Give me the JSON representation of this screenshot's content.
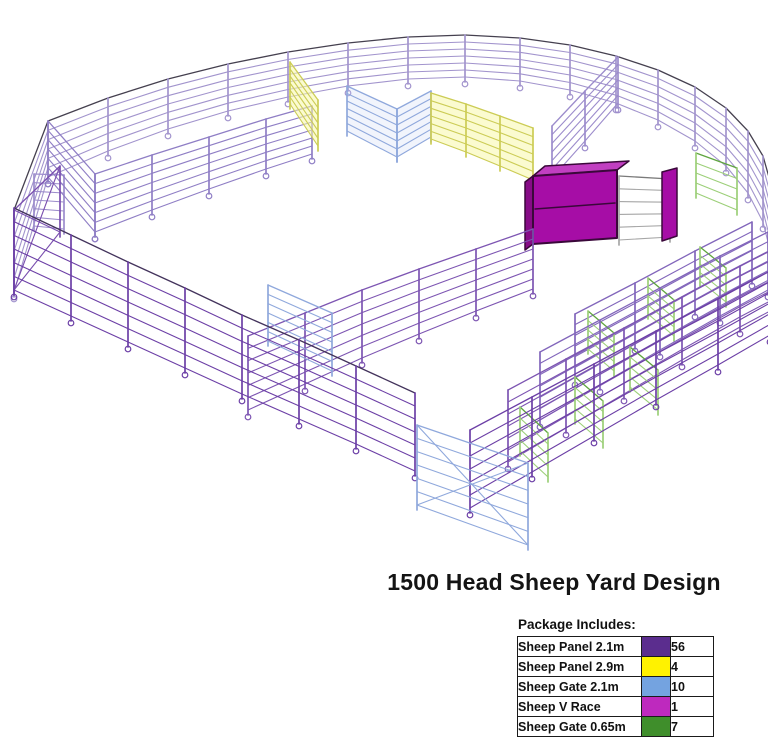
{
  "title": "1500 Head Sheep Yard Design",
  "legend": {
    "header": "Package Includes:",
    "rows": [
      {
        "label": "Sheep Panel 2.1m",
        "color": "#5B2D8E",
        "qty": "56"
      },
      {
        "label": "Sheep Panel 2.9m",
        "color": "#FFF200",
        "qty": "4"
      },
      {
        "label": "Sheep Gate 2.1m",
        "color": "#74A3E0",
        "qty": "10"
      },
      {
        "label": "Sheep V Race",
        "color": "#BE29BE",
        "qty": "1"
      },
      {
        "label": "Sheep Gate 0.65m",
        "color": "#3F8E2B",
        "qty": "7"
      }
    ]
  },
  "diagram": {
    "width": 768,
    "height": 560,
    "colors": {
      "panel_far": "#A294CD",
      "panel_near": "#6C3FA6",
      "panel_mid": "#8266BB",
      "panel_soft": "#8F7EC5",
      "gate_blue": "#8FA8DC",
      "gate_green": "#9CCF78",
      "green_dark": "#5FA53F",
      "panel_yellow": "#CCCC55",
      "vrace_fill": "#A60DA6",
      "vrace_top": "#C13FC1",
      "vrace_dark": "#3A083A",
      "grey": "#A6A6A6",
      "top_rail": "#45404F"
    },
    "elements": [
      {
        "kind": "fence",
        "name": "perimeter-far",
        "c": "#A294CD",
        "top": "#45404F",
        "feet": true,
        "pts": [
          [
            14,
            292,
            82
          ],
          [
            48,
            177,
            56
          ],
          [
            108,
            151,
            53
          ],
          [
            168,
            129,
            50
          ],
          [
            228,
            111,
            47
          ],
          [
            288,
            97,
            45
          ],
          [
            348,
            86,
            43
          ],
          [
            408,
            79,
            42
          ],
          [
            465,
            77,
            42
          ],
          [
            520,
            81,
            43
          ],
          [
            570,
            90,
            45
          ],
          [
            616,
            103,
            47
          ],
          [
            658,
            120,
            50
          ],
          [
            695,
            141,
            54
          ],
          [
            726,
            166,
            58
          ],
          [
            748,
            193,
            62
          ],
          [
            763,
            222,
            66
          ],
          [
            772,
            258,
            70
          ]
        ]
      },
      {
        "kind": "fence",
        "name": "gate-top-left",
        "c": "#9C8CCC",
        "feet": false,
        "pts": [
          [
            34,
            226,
            52
          ],
          [
            64,
            229,
            54
          ]
        ]
      },
      {
        "kind": "fence",
        "name": "spur-top-left",
        "c": "#8F7EC5",
        "feet": true,
        "pts": [
          [
            48,
            177,
            56
          ],
          [
            95,
            232,
            58
          ]
        ]
      },
      {
        "kind": "fence",
        "name": "spur-forcing",
        "c": "#9C8CCC",
        "feet": true,
        "pts": [
          [
            618,
            103,
            46
          ],
          [
            585,
            141,
            50
          ],
          [
            552,
            178,
            52
          ]
        ]
      },
      {
        "kind": "fence",
        "name": "divider-1",
        "c": "#8F7EC5",
        "feet": true,
        "pts": [
          [
            95,
            232,
            58
          ],
          [
            152,
            210,
            55
          ],
          [
            209,
            189,
            52
          ],
          [
            266,
            169,
            50
          ],
          [
            312,
            154,
            48
          ]
        ]
      },
      {
        "kind": "fence",
        "name": "panel-yellow-left",
        "c": "#CCCC55",
        "fill": "rgba(247,247,170,0.55)",
        "feet": false,
        "pts": [
          [
            290,
            104,
            42
          ],
          [
            318,
            146,
            46
          ]
        ]
      },
      {
        "kind": "fence",
        "name": "gate-mid-1",
        "c": "#8FA8DC",
        "fill": "rgba(190,205,240,0.22)",
        "feet": false,
        "pts": [
          [
            347,
            131,
            45
          ],
          [
            397,
            157,
            48
          ]
        ]
      },
      {
        "kind": "fence",
        "name": "gate-mid-2",
        "c": "#8FA8DC",
        "fill": "rgba(190,205,240,0.22)",
        "feet": false,
        "pts": [
          [
            397,
            157,
            48
          ],
          [
            431,
            137,
            46
          ]
        ]
      },
      {
        "kind": "fence",
        "name": "panels-yellow-run",
        "c": "#CCCC55",
        "fill": "rgba(247,247,170,0.55)",
        "feet": false,
        "pts": [
          [
            431,
            139,
            46
          ],
          [
            466,
            152,
            48
          ],
          [
            500,
            166,
            50
          ],
          [
            533,
            180,
            52
          ]
        ]
      },
      {
        "kind": "polygon",
        "name": "vrace-top-face",
        "fill": "#C13FC1",
        "stroke": "#3A083A",
        "w": 1.5,
        "pts": [
          [
            533,
            176
          ],
          [
            617,
            170
          ],
          [
            629,
            161
          ],
          [
            545,
            166
          ]
        ]
      },
      {
        "kind": "polygon",
        "name": "vrace-left-face",
        "fill": "#870B87",
        "stroke": "#3A083A",
        "w": 1.5,
        "pts": [
          [
            525,
            182
          ],
          [
            533,
            176
          ],
          [
            533,
            244
          ],
          [
            525,
            250
          ]
        ]
      },
      {
        "kind": "polygon",
        "name": "vrace-front-face",
        "fill": "#A60DA6",
        "stroke": "#3A083A",
        "w": 2,
        "pts": [
          [
            533,
            176
          ],
          [
            617,
            170
          ],
          [
            617,
            238
          ],
          [
            533,
            244
          ]
        ]
      },
      {
        "kind": "line",
        "name": "vrace-seam",
        "stroke": "#3A083A",
        "w": 1.5,
        "pts": [
          [
            535,
            209
          ],
          [
            615,
            203
          ]
        ]
      },
      {
        "kind": "fence",
        "name": "race-chassis-grey",
        "c": "#A6A6A6",
        "top": "#7A7A7A",
        "rails": 6,
        "feet": false,
        "pts": [
          [
            619,
            240,
            64
          ],
          [
            670,
            237,
            58
          ]
        ]
      },
      {
        "kind": "polygon",
        "name": "vrace-draft-panel",
        "fill": "#A60DA6",
        "stroke": "#3A083A",
        "w": 1.5,
        "pts": [
          [
            662,
            172
          ],
          [
            677,
            168
          ],
          [
            677,
            236
          ],
          [
            662,
            241
          ]
        ]
      },
      {
        "kind": "fence",
        "name": "gate-green-7",
        "c": "#9CCF78",
        "top": "#5FA53F",
        "rails": 5,
        "feet": false,
        "pts": [
          [
            696,
            193,
            40
          ],
          [
            737,
            210,
            42
          ]
        ]
      },
      {
        "kind": "fence",
        "name": "pen-fence-5",
        "c": "#8266BB",
        "feet": true,
        "pts": [
          [
            575,
            378,
            64
          ],
          [
            635,
            344,
            61
          ],
          [
            695,
            310,
            59
          ],
          [
            752,
            279,
            57
          ]
        ]
      },
      {
        "kind": "fence",
        "name": "gate-green-4",
        "c": "#9CCF78",
        "top": "#5FA53F",
        "rails": 5,
        "feet": false,
        "pts": [
          [
            588,
            349,
            38
          ],
          [
            614,
            371,
            38
          ]
        ]
      },
      {
        "kind": "fence",
        "name": "gate-green-5",
        "c": "#9CCF78",
        "top": "#5FA53F",
        "rails": 5,
        "feet": false,
        "pts": [
          [
            648,
            314,
            36
          ],
          [
            674,
            336,
            36
          ]
        ]
      },
      {
        "kind": "fence",
        "name": "gate-green-6",
        "c": "#9CCF78",
        "top": "#5FA53F",
        "rails": 5,
        "feet": false,
        "pts": [
          [
            700,
            281,
            34
          ],
          [
            726,
            302,
            34
          ]
        ]
      },
      {
        "kind": "fence",
        "name": "pen-fence-4",
        "c": "#8266BB",
        "feet": true,
        "pts": [
          [
            540,
            420,
            68
          ],
          [
            600,
            385,
            65
          ],
          [
            660,
            350,
            62
          ],
          [
            720,
            316,
            60
          ],
          [
            768,
            290,
            58
          ]
        ]
      },
      {
        "kind": "fence",
        "name": "divider-2",
        "c": "#7D55B2",
        "feet": true,
        "pts": [
          [
            248,
            410,
            74
          ],
          [
            305,
            384,
            71
          ],
          [
            362,
            358,
            68
          ],
          [
            419,
            334,
            65
          ],
          [
            476,
            311,
            62
          ],
          [
            533,
            289,
            60
          ]
        ]
      },
      {
        "kind": "fence",
        "name": "gate-divider-2",
        "c": "#8FA8DC",
        "feet": false,
        "pts": [
          [
            268,
            341,
            56
          ],
          [
            332,
            371,
            58
          ]
        ]
      },
      {
        "kind": "fence",
        "name": "race-fence-3",
        "c": "#7D55B2",
        "feet": true,
        "pts": [
          [
            508,
            462,
            72
          ],
          [
            566,
            428,
            69
          ],
          [
            624,
            394,
            66
          ],
          [
            682,
            360,
            63
          ],
          [
            740,
            327,
            61
          ],
          [
            772,
            310,
            60
          ]
        ]
      },
      {
        "kind": "fence",
        "name": "gate-green-1",
        "c": "#9CCF78",
        "top": "#5FA53F",
        "rails": 5,
        "feet": false,
        "pts": [
          [
            520,
            451,
            44
          ],
          [
            548,
            477,
            44
          ]
        ]
      },
      {
        "kind": "fence",
        "name": "gate-green-2",
        "c": "#9CCF78",
        "top": "#5FA53F",
        "rails": 5,
        "feet": false,
        "pts": [
          [
            575,
            419,
            42
          ],
          [
            603,
            443,
            42
          ]
        ]
      },
      {
        "kind": "fence",
        "name": "gate-green-3",
        "c": "#9CCF78",
        "top": "#5FA53F",
        "rails": 5,
        "feet": false,
        "pts": [
          [
            630,
            387,
            40
          ],
          [
            658,
            410,
            40
          ]
        ]
      },
      {
        "kind": "fence",
        "name": "race-fence-2",
        "c": "#6C3FA6",
        "feet": true,
        "pts": [
          [
            470,
            508,
            78
          ],
          [
            532,
            472,
            75
          ],
          [
            594,
            436,
            72
          ],
          [
            656,
            400,
            69
          ],
          [
            718,
            365,
            66
          ],
          [
            770,
            335,
            64
          ]
        ]
      },
      {
        "kind": "fence",
        "name": "left-end-brace",
        "c": "#7A4FAF",
        "rails": 2,
        "diag": true,
        "feet": false,
        "pts": [
          [
            14,
            290,
            80
          ],
          [
            60,
            232,
            66
          ]
        ]
      },
      {
        "kind": "fence",
        "name": "front-left",
        "c": "#6C3FA6",
        "top": "#43335C",
        "feet": true,
        "pts": [
          [
            14,
            290,
            82
          ],
          [
            71,
            316,
            81
          ],
          [
            128,
            342,
            80
          ],
          [
            185,
            368,
            80
          ],
          [
            242,
            394,
            79
          ],
          [
            299,
            419,
            79
          ],
          [
            356,
            444,
            78
          ],
          [
            415,
            471,
            78
          ]
        ]
      },
      {
        "kind": "fence",
        "name": "gate-corner-blue",
        "c": "#8FA8DC",
        "diag": true,
        "feet": false,
        "pts": [
          [
            417,
            505,
            80
          ],
          [
            528,
            545,
            82
          ]
        ]
      }
    ]
  }
}
